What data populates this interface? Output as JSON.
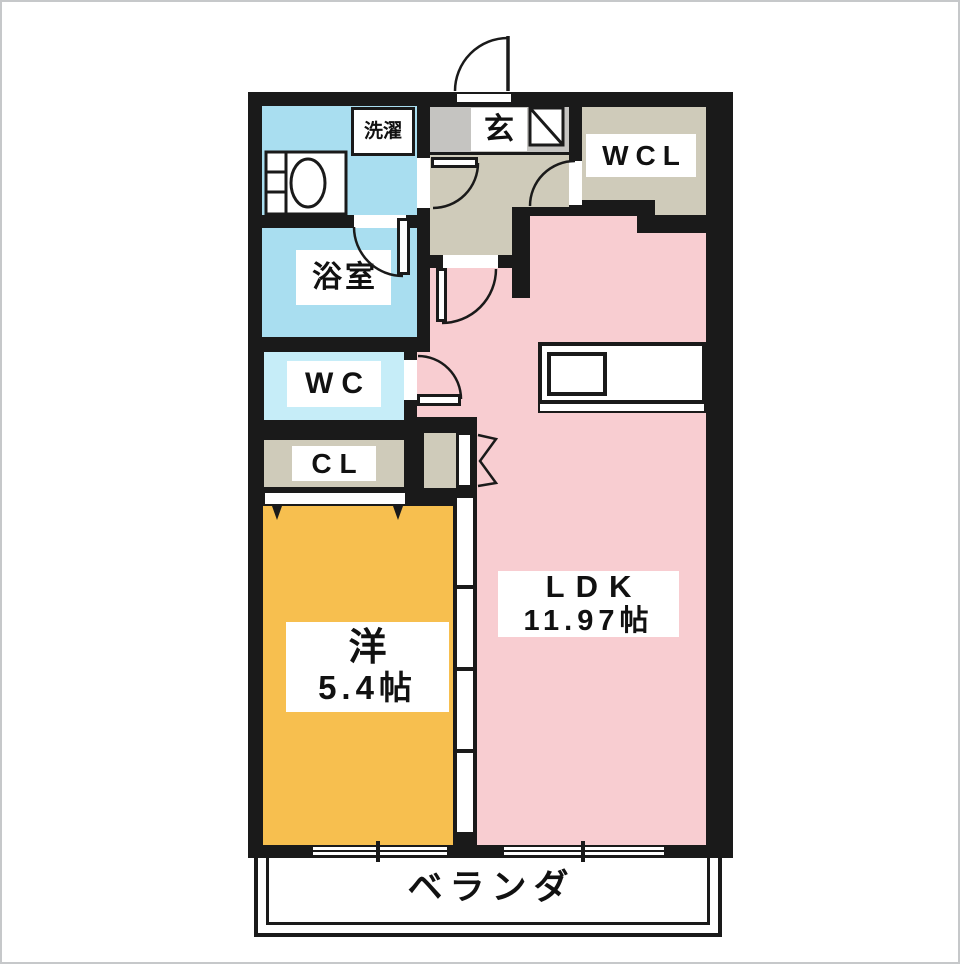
{
  "floorplan": {
    "labels": {
      "laundry": "洗濯",
      "entrance": "玄",
      "walk_in_closet": "WCL",
      "bathroom": "浴室",
      "toilet": "WC",
      "closet": "CL",
      "western_room_name": "洋",
      "western_room_size": "5.4帖",
      "ldk_name": "LDK",
      "ldk_size": "11.97帖",
      "balcony": "ベランダ"
    },
    "colors": {
      "wall": "#1a1a1a",
      "wet_blue": "#a9def0",
      "wc_blue": "#c6edf8",
      "beige": "#cfcbba",
      "entrance_gray": "#c5c4c1",
      "ldk_pink": "#f8cdd1",
      "room_orange": "#f7bf4f",
      "label_bg": "#ffffff"
    }
  }
}
